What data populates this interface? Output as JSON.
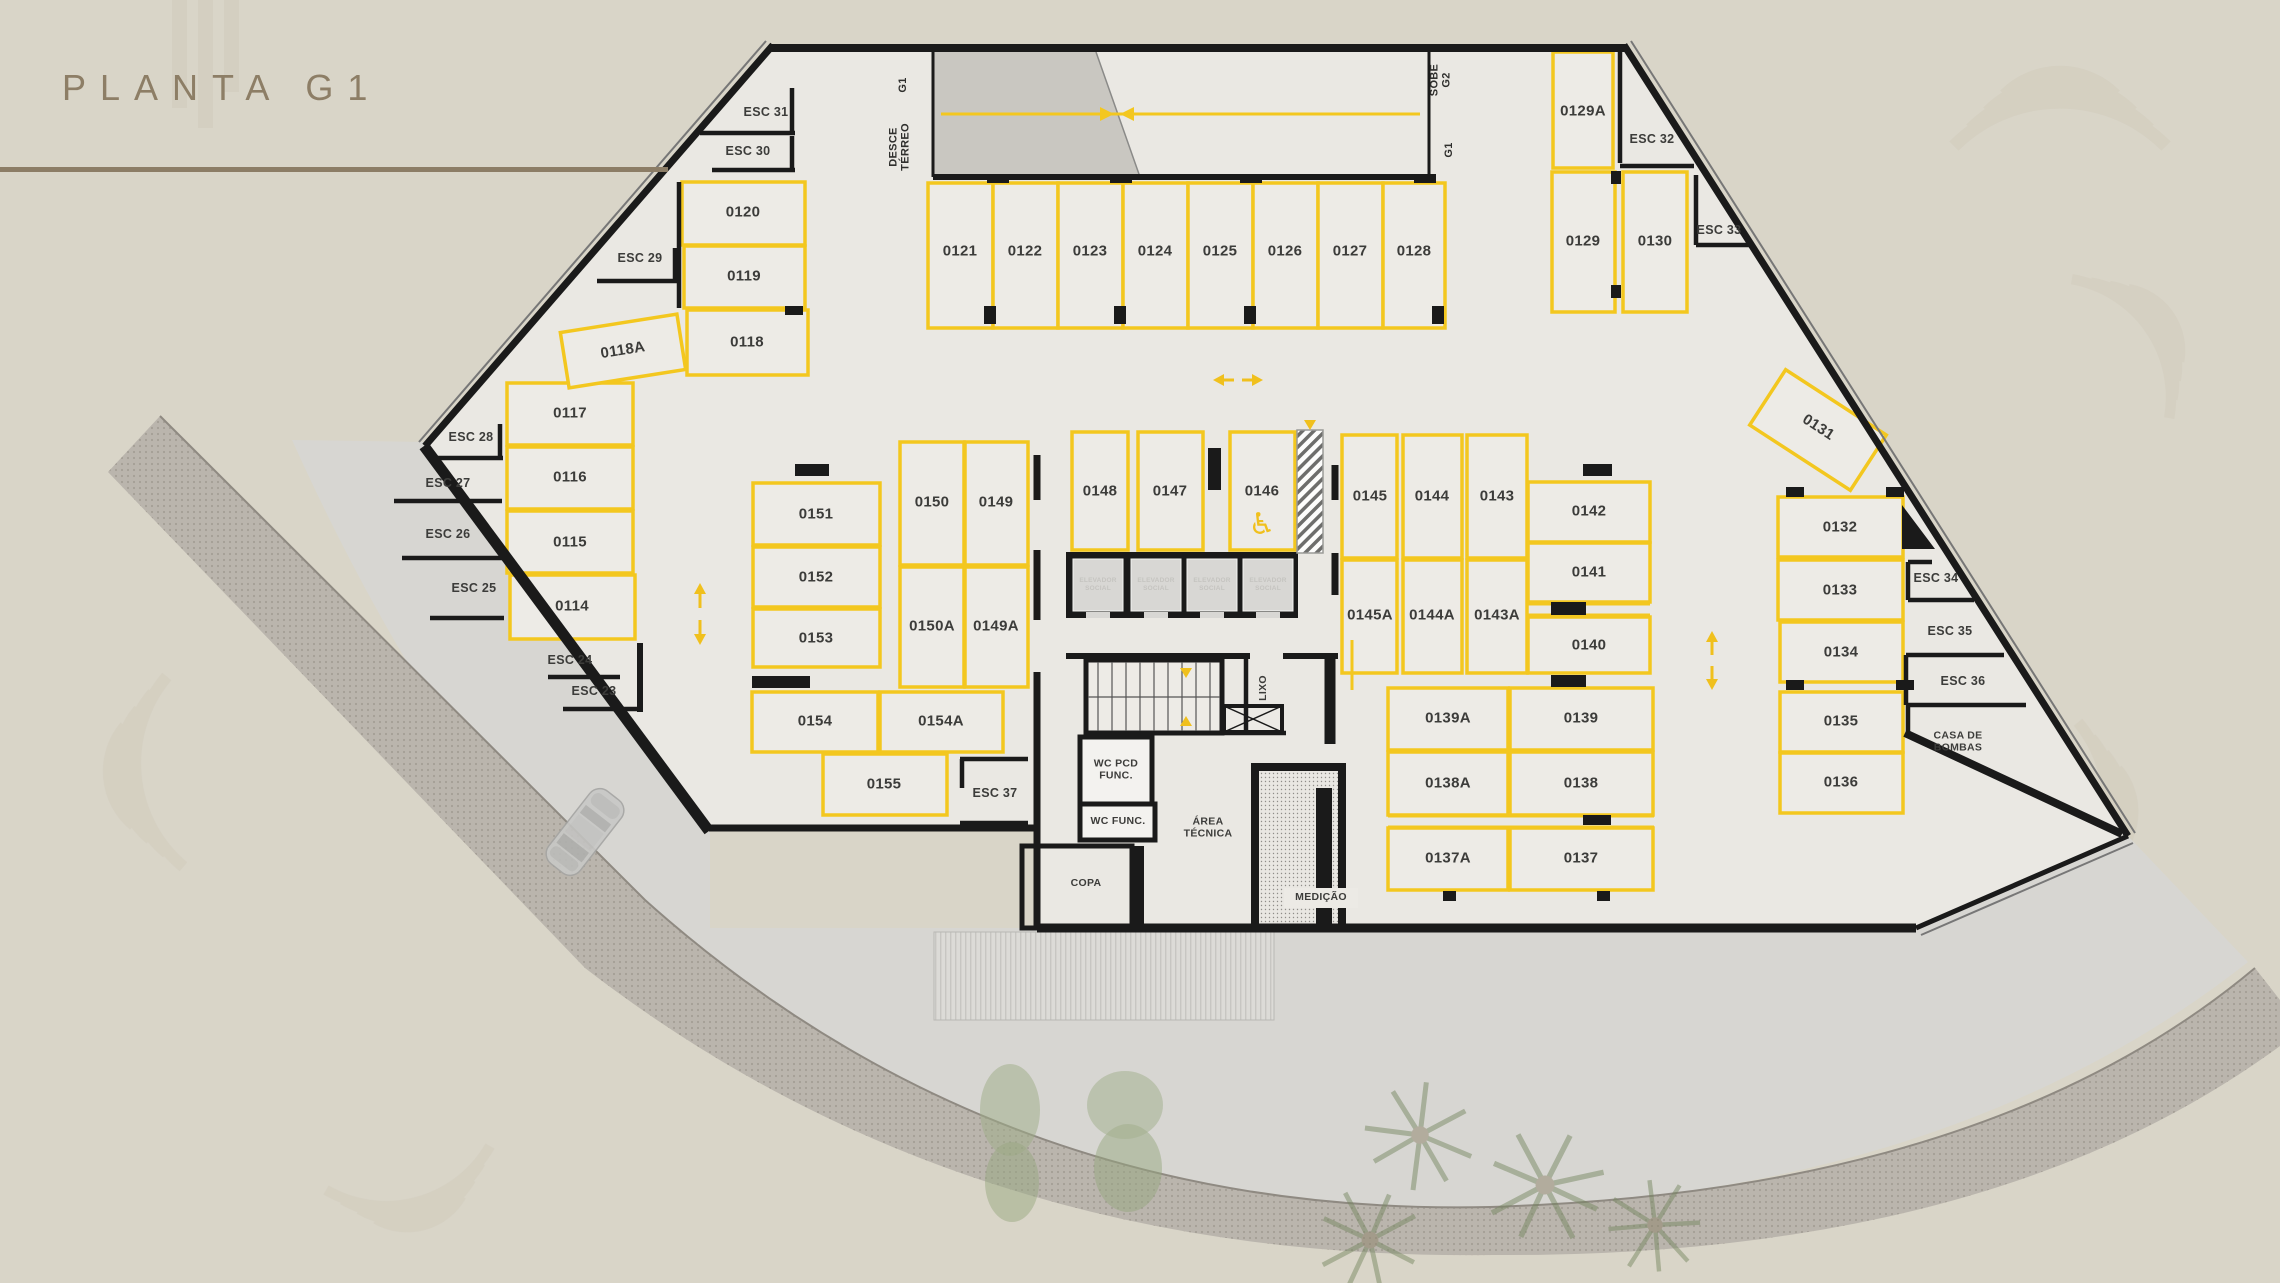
{
  "title": "PLANTA G1",
  "colors": {
    "background": "#d9d5c8",
    "floor": "#eae8e3",
    "stall_yellow": "#f3c71f",
    "wall_black": "#1a1a1a",
    "title_brown": "#8c7d66"
  },
  "ramp": {
    "left_level": "G1",
    "left_direction": "DESCE TÉRREO",
    "right_direction": "SOBE G2",
    "right_level": "G1"
  },
  "spots": {
    "p0114": "0114",
    "p0115": "0115",
    "p0116": "0116",
    "p0117": "0117",
    "p0118": "0118",
    "p0118a": "0118A",
    "p0119": "0119",
    "p0120": "0120",
    "p0121": "0121",
    "p0122": "0122",
    "p0123": "0123",
    "p0124": "0124",
    "p0125": "0125",
    "p0126": "0126",
    "p0127": "0127",
    "p0128": "0128",
    "p0129": "0129",
    "p0129a": "0129A",
    "p0130": "0130",
    "p0131": "0131",
    "p0132": "0132",
    "p0133": "0133",
    "p0134": "0134",
    "p0135": "0135",
    "p0136": "0136",
    "p0137": "0137",
    "p0137a": "0137A",
    "p0138": "0138",
    "p0138a": "0138A",
    "p0139": "0139",
    "p0139a": "0139A",
    "p0140": "0140",
    "p0141": "0141",
    "p0142": "0142",
    "p0143": "0143",
    "p0143a": "0143A",
    "p0144": "0144",
    "p0144a": "0144A",
    "p0145": "0145",
    "p0145a": "0145A",
    "p0146": "0146",
    "p0147": "0147",
    "p0148": "0148",
    "p0149": "0149",
    "p0149a": "0149A",
    "p0150": "0150",
    "p0150a": "0150A",
    "p0151": "0151",
    "p0152": "0152",
    "p0153": "0153",
    "p0154": "0154",
    "p0154a": "0154A",
    "p0155": "0155"
  },
  "stairs": {
    "esc23": "ESC 23",
    "esc24": "ESC 24",
    "esc25": "ESC 25",
    "esc26": "ESC 26",
    "esc27": "ESC 27",
    "esc28": "ESC 28",
    "esc29": "ESC 29",
    "esc30": "ESC 30",
    "esc31": "ESC 31",
    "esc32": "ESC 32",
    "esc33": "ESC 33",
    "esc34": "ESC 34",
    "esc35": "ESC 35",
    "esc36": "ESC 36",
    "esc37": "ESC 37"
  },
  "rooms": {
    "elevator": "ELEVADOR SOCIAL",
    "lixo": "LIXO",
    "wc_pcd": "WC PCD FUNC.",
    "wc_func": "WC FUNC.",
    "copa": "COPA",
    "area_tecnica": "ÁREA TÉCNICA",
    "medicao": "MEDIÇÃO",
    "casa_de_bombas": "CASA DE BOMBAS"
  }
}
